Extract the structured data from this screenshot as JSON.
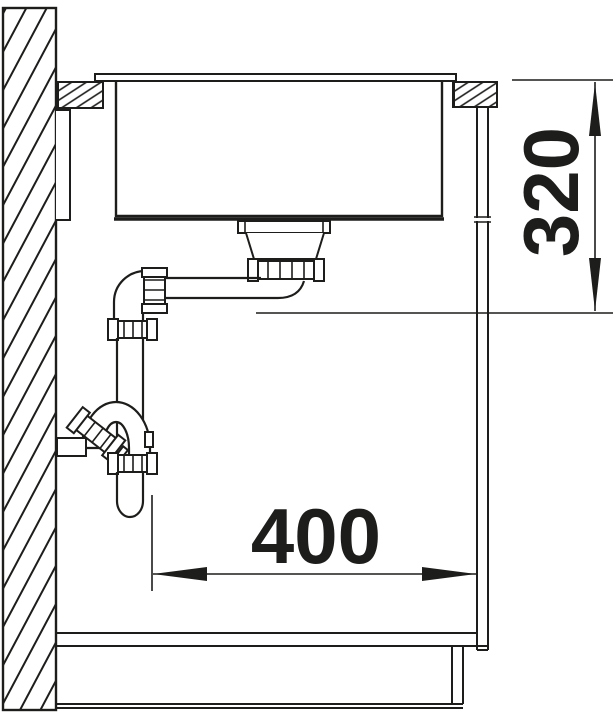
{
  "drawing": {
    "title": "sink-installation-section",
    "background_color": "#ffffff",
    "line_color": "#1d1d1b",
    "dimensions": {
      "vertical": {
        "value": "320",
        "orientation": "vertical"
      },
      "horizontal": {
        "value": "400",
        "orientation": "horizontal"
      }
    }
  }
}
